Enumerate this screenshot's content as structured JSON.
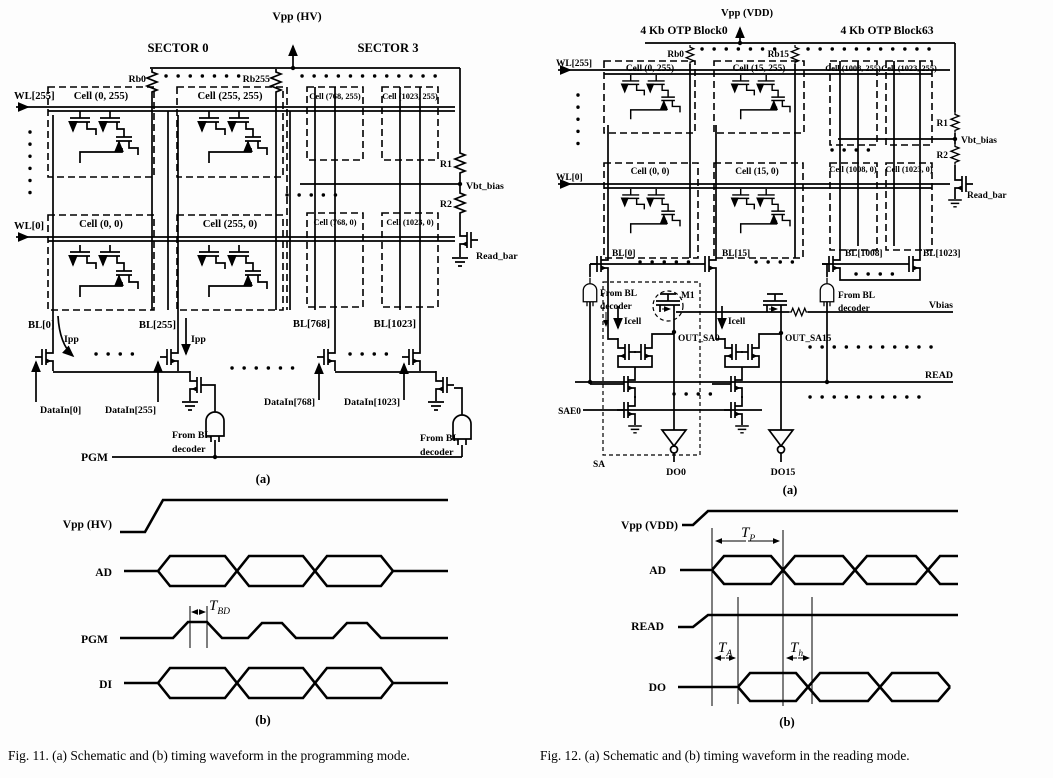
{
  "fig11": {
    "schematic": {
      "supply": "Vpp (HV)",
      "sector0": "SECTOR 0",
      "sector3": "SECTOR 3",
      "rb0": "Rb0",
      "rb255": "Rb255",
      "wl255": "WL[255]",
      "wl0": "WL[0]",
      "cells": [
        "Cell (0, 255)",
        "Cell (255, 255)",
        "Cell (768, 255)",
        "Cell (1023, 255)",
        "Cell (0, 0)",
        "Cell (255, 0)",
        "Cell (768, 0)",
        "Cell (1023, 0)"
      ],
      "r1": "R1",
      "r2": "R2",
      "vbt_bias": "Vbt_bias",
      "read_bar": "Read_bar",
      "bl": [
        "BL[0]",
        "BL[255]",
        "BL[768]",
        "BL[1023]"
      ],
      "ipp": "Ipp",
      "datain": [
        "DataIn[0]",
        "DataIn[255]",
        "DataIn[768]",
        "DataIn[1023]"
      ],
      "from_bl": "From BL",
      "decoder": "decoder",
      "pgm": "PGM",
      "panel": "(a)"
    },
    "waveform": {
      "vpp": "Vpp (HV)",
      "ad": "AD",
      "pgm": "PGM",
      "di": "DI",
      "t": "T",
      "sub_bd": "BD",
      "panel": "(b)"
    },
    "caption": "Fig. 11.  (a) Schematic and (b) timing waveform in the programming mode."
  },
  "fig12": {
    "schematic": {
      "supply": "Vpp (VDD)",
      "block0": "4 Kb OTP Block0",
      "block63": "4 Kb OTP Block63",
      "rb0": "Rb0",
      "rb15": "Rb15",
      "wl255": "WL[255]",
      "wl0": "WL[0]",
      "cells": [
        "Cell (0, 255)",
        "Cell (15, 255)",
        "Cell (1008, 255)",
        "Cell (1023, 255)",
        "Cell (0, 0)",
        "Cell (15, 0)",
        "Cell (1008, 0)",
        "Cell (1023, 0)"
      ],
      "r1": "R1",
      "r2": "R2",
      "vbt_bias": "Vbt_bias",
      "read_bar": "Read_bar",
      "bl": [
        "BL[0]",
        "BL[15]",
        "BL[1008]",
        "BL[1023]"
      ],
      "from_bl": "From BL",
      "decoder": "decoder",
      "icell": "Icell",
      "m1": "M1",
      "out_sa0": "OUT_SA0",
      "out_sa15": "OUT_SA15",
      "sae0": "SAE0",
      "sa": "SA",
      "do0": "DO0",
      "do15": "DO15",
      "vbias": "Vbias",
      "read": "READ",
      "panel": "(a)"
    },
    "waveform": {
      "vpp": "Vpp (VDD)",
      "ad": "AD",
      "read": "READ",
      "do": "DO",
      "t": "T",
      "sub_p": "P",
      "sub_a": "A",
      "sub_h": "h",
      "panel": "(b)"
    },
    "caption": "Fig. 12.  (a) Schematic and (b) timing waveform in the reading mode."
  }
}
